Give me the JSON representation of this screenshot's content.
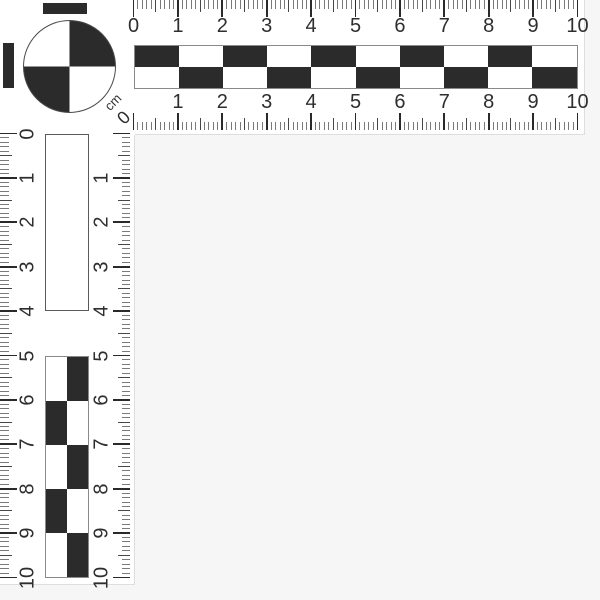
{
  "scale": {
    "unit_label": "cm",
    "corner_zero": "0",
    "cm_count": 10,
    "minor_ticks_per_cm": 10,
    "top_outer_ruler": {
      "numbers": [
        "0",
        "1",
        "2",
        "3",
        "4",
        "5",
        "6",
        "7",
        "8",
        "9",
        "10"
      ]
    },
    "top_inner_ruler": {
      "numbers": [
        "1",
        "2",
        "3",
        "4",
        "5",
        "6",
        "7",
        "8",
        "9",
        "10"
      ]
    },
    "left_outer_ruler": {
      "numbers": [
        "0",
        "1",
        "2",
        "3",
        "4",
        "5",
        "6",
        "7",
        "8",
        "9",
        "10"
      ]
    },
    "left_inner_ruler": {
      "numbers": [
        "1",
        "2",
        "3",
        "4",
        "5",
        "6",
        "7",
        "8",
        "9",
        "10"
      ]
    },
    "horizontal_checkerboard": {
      "columns": 10,
      "rows": 2,
      "first_cell_dark": true
    },
    "vertical_checkerboard": {
      "columns": 2,
      "rows": 5,
      "first_cell_dark": false
    },
    "circle_target": {
      "top_left": "white",
      "top_right": "dark",
      "bottom_left": "dark",
      "bottom_right": "white"
    }
  },
  "colors": {
    "dark": "#2b2b2b",
    "scale_white": "#ffffff",
    "background": "#f6f6f6",
    "tick_major": "#2a2a2a",
    "tick_mid": "#474747",
    "tick_minor": "#7a7a7a",
    "text": "#2e2e2e",
    "outline": "#8a8a8a"
  }
}
